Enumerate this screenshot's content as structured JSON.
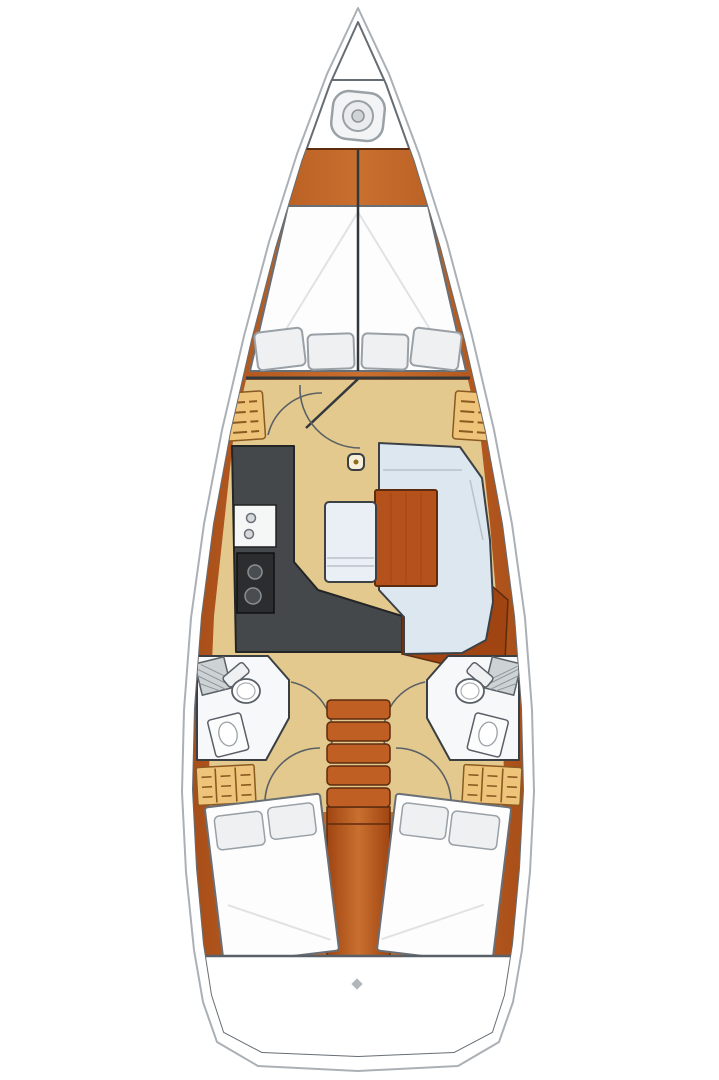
{
  "diagram": {
    "name": "sailboat-interior-floor-plan",
    "orientation": "bow-top-stern-bottom",
    "areas": {
      "bow_locker": "anchor windlass locker",
      "forward_cabin": "V-berth double bed, 4 pillows",
      "forward_shelves": "port and starboard slatted lockers",
      "galley": "L-counter, double sink, 2-burner stove",
      "salon": "U-settee, wood table, center bench, mast post",
      "heads": "port and starboard bathrooms, toilet and sink",
      "companionway": "5-step ladder over engine box",
      "aft_cabins": "port and starboard double beds, 2 pillows each",
      "transom": "stern platform"
    },
    "icons": [
      "windlass-icon",
      "stern-marker-icon"
    ]
  },
  "colors": {
    "deck": "#ffffff",
    "hull_outer_line": "#aab0b5",
    "hull_inner_line": "#666d73",
    "wood_dark": "#a04512",
    "wood": "#b65a21",
    "wood_light": "#c9702f",
    "wood_edge": "#5d2c0e",
    "floor": "#e3c98e",
    "counter": "#45484a",
    "counter_edge": "#232526",
    "stove": "#2b2d2f",
    "burner": "#4a4d4f",
    "burner_edge": "#8a8f93",
    "appliance": "#f5f6f6",
    "settee": "#dde7f0",
    "cushion_edge": "#3c4146",
    "bench": "#e9eff5",
    "table": "#b5521c",
    "bed": "#fdfdfe",
    "bed_edge": "#696f75",
    "pillow": "#eef0f2",
    "pillow_edge": "#99a0a6",
    "locker": "#eec37a",
    "locker_edge": "#8a5a20",
    "steps": "#c05f24",
    "head_floor": "#f7f8f9",
    "fixture_edge": "#596067",
    "hatch": "#cdd2d5",
    "hatch_line": "#8f969c",
    "bulkhead": "#33383c",
    "mast_fill": "#f7efd8",
    "mast_dot": "#8a6b1f",
    "glyph": "#b0b6ba",
    "icon_line": "#9aa1a6",
    "icon_fill": "#f3f4f5"
  }
}
